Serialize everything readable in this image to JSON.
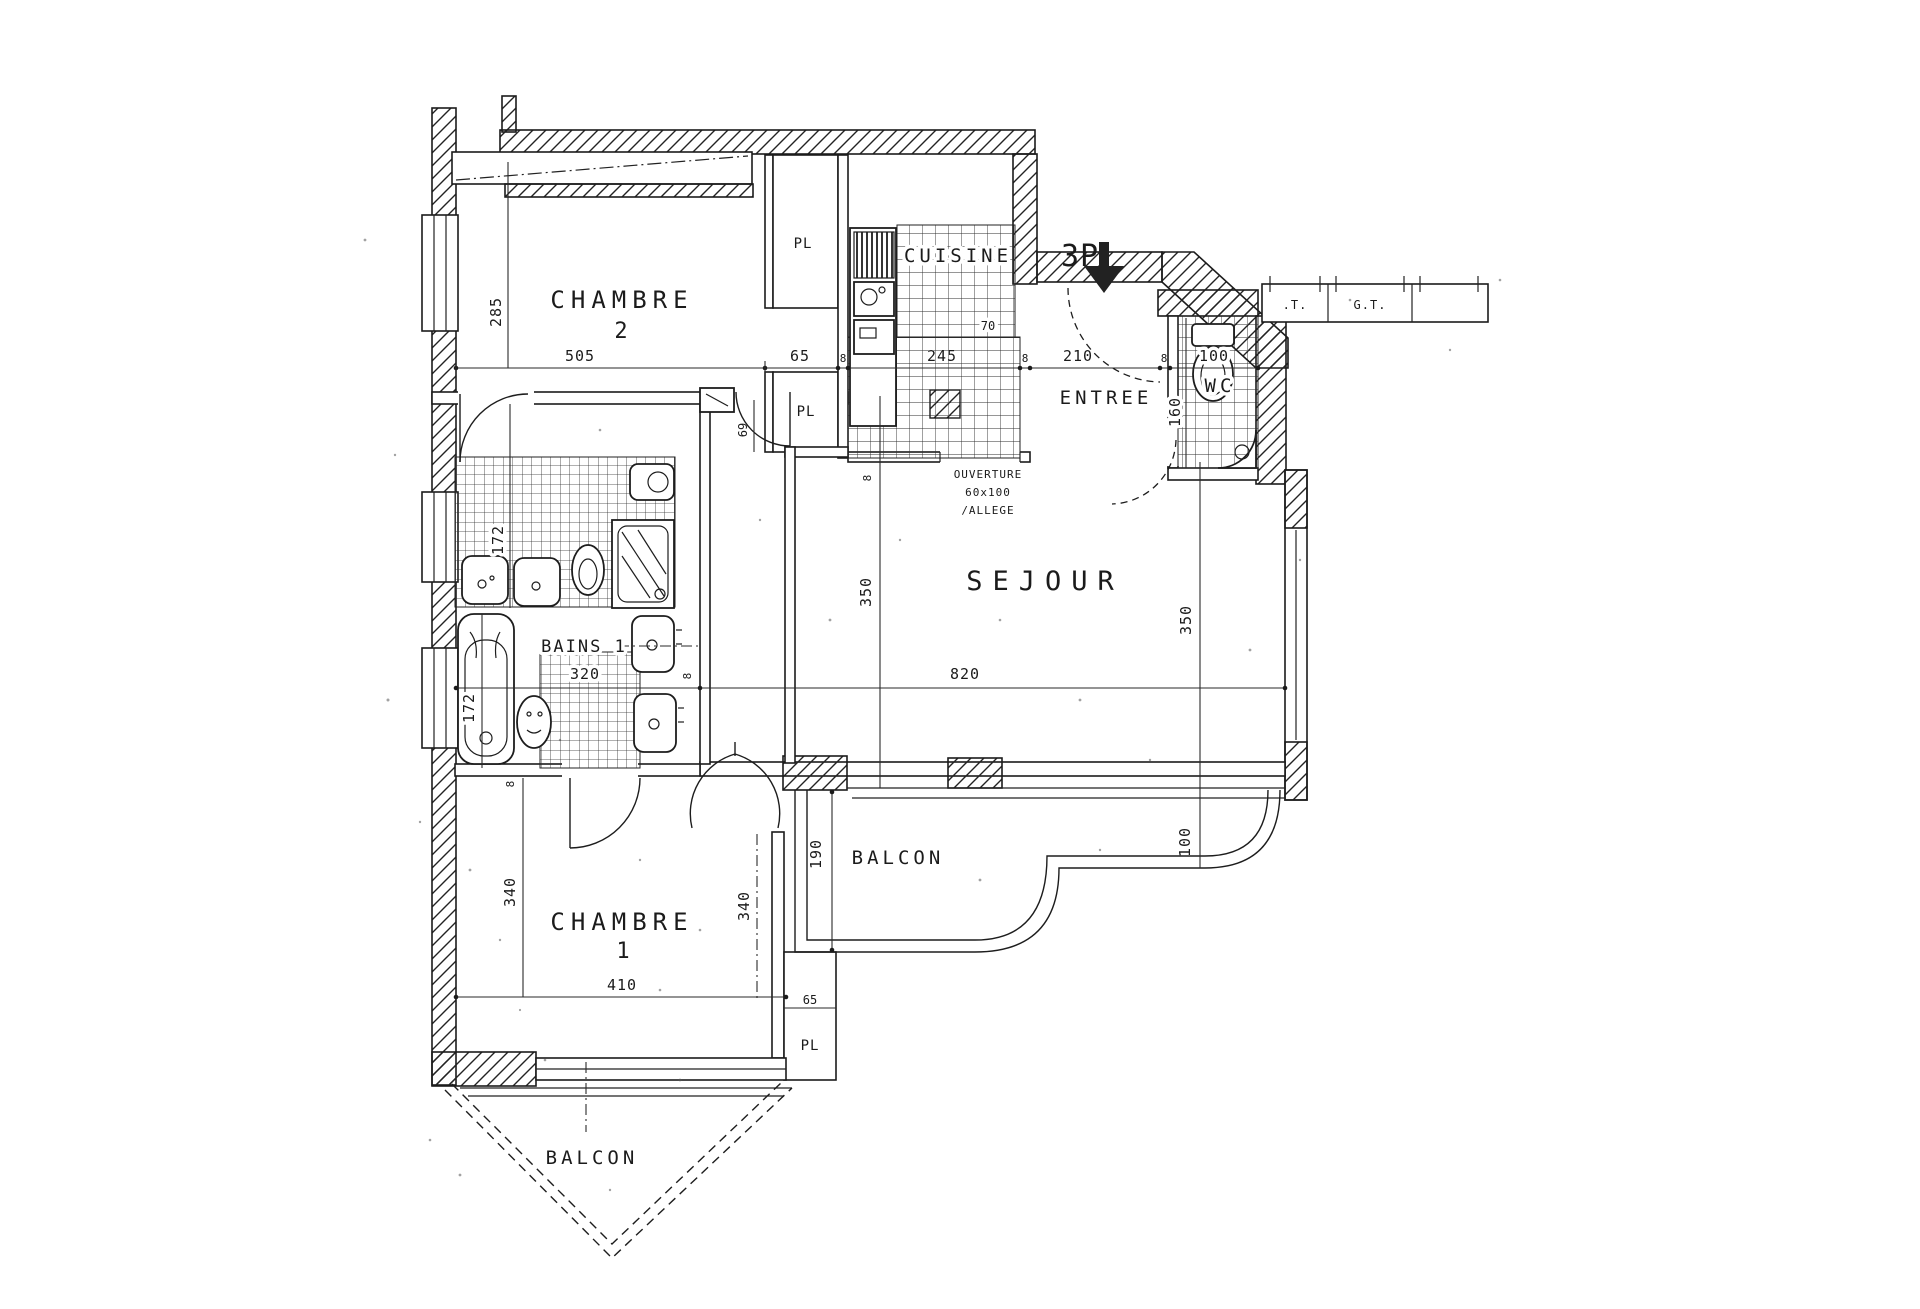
{
  "rooms": {
    "chambre2": {
      "name": "CHAMBRE",
      "number": "2"
    },
    "cuisine": {
      "name": "CUISINE"
    },
    "entree": {
      "name": "ENTREE"
    },
    "wc": {
      "name": "WC"
    },
    "sejour": {
      "name": "SEJOUR"
    },
    "bains": {
      "name": "BAINS 1"
    },
    "chambre1": {
      "name": "CHAMBRE",
      "number": "1"
    },
    "balcon_east": {
      "name": "BALCON"
    },
    "balcon_south": {
      "name": "BALCON"
    }
  },
  "closets": {
    "pl_chambre2_top": "PL",
    "pl_hall": "PL",
    "pl_chambre1": "PL"
  },
  "ducts": {
    "t": ".T.",
    "gt": "G.T."
  },
  "dimensions": {
    "chain": {
      "chambre2": "505",
      "pl": "65",
      "wall_a": "8",
      "cuisine": "245",
      "wall_b": "8",
      "entree": "210",
      "wall_c": "8",
      "wc": "100"
    },
    "chambre2_depth": "285",
    "cuisine_return": "70",
    "wc_depth": "160",
    "sejour_width": "820",
    "sejour_depth_left": "350",
    "sejour_depth_right": "350",
    "bains_width": "320",
    "bains_depth_upper": "172",
    "bains_depth_lower": "172",
    "hall_door_width": "69",
    "chambre1_width": "410",
    "chambre1_depth_left": "340",
    "chambre1_depth_right": "340",
    "chambre1_pl_width": "65",
    "balcon_depth": "190",
    "balcon_depth_right": "100",
    "wall_tick_a": "8",
    "wall_tick_b": "8",
    "wall_tick_c": "8"
  },
  "annotations": {
    "type_marker": "3P",
    "ouverture": {
      "line1": "OUVERTURE",
      "line2": "60x100",
      "line3": "/ALLEGE"
    }
  }
}
